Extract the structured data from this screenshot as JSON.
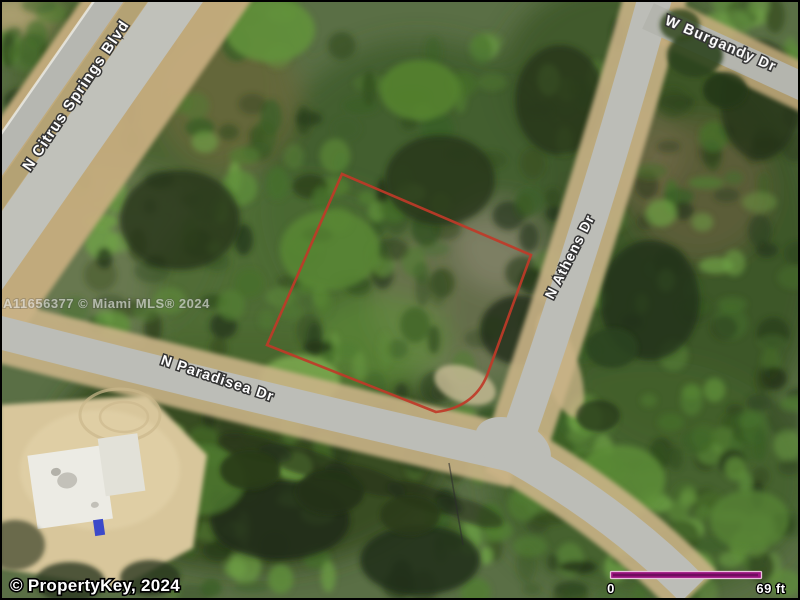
{
  "map": {
    "streets": [
      {
        "name": "N Citrus Springs Blvd"
      },
      {
        "name": "W Burgandy Dr"
      },
      {
        "name": "N Athens Dr"
      },
      {
        "name": "N Paradisea Dr"
      }
    ],
    "watermark": "A11656377 © Miami MLS® 2024",
    "parcel": {
      "outline_color": "#bf3a28"
    }
  },
  "overlay": {
    "copyright": "© PropertyKey, 2024",
    "scale": {
      "start": "0",
      "end": "69 ft",
      "bar_color": "#9c1480"
    }
  }
}
